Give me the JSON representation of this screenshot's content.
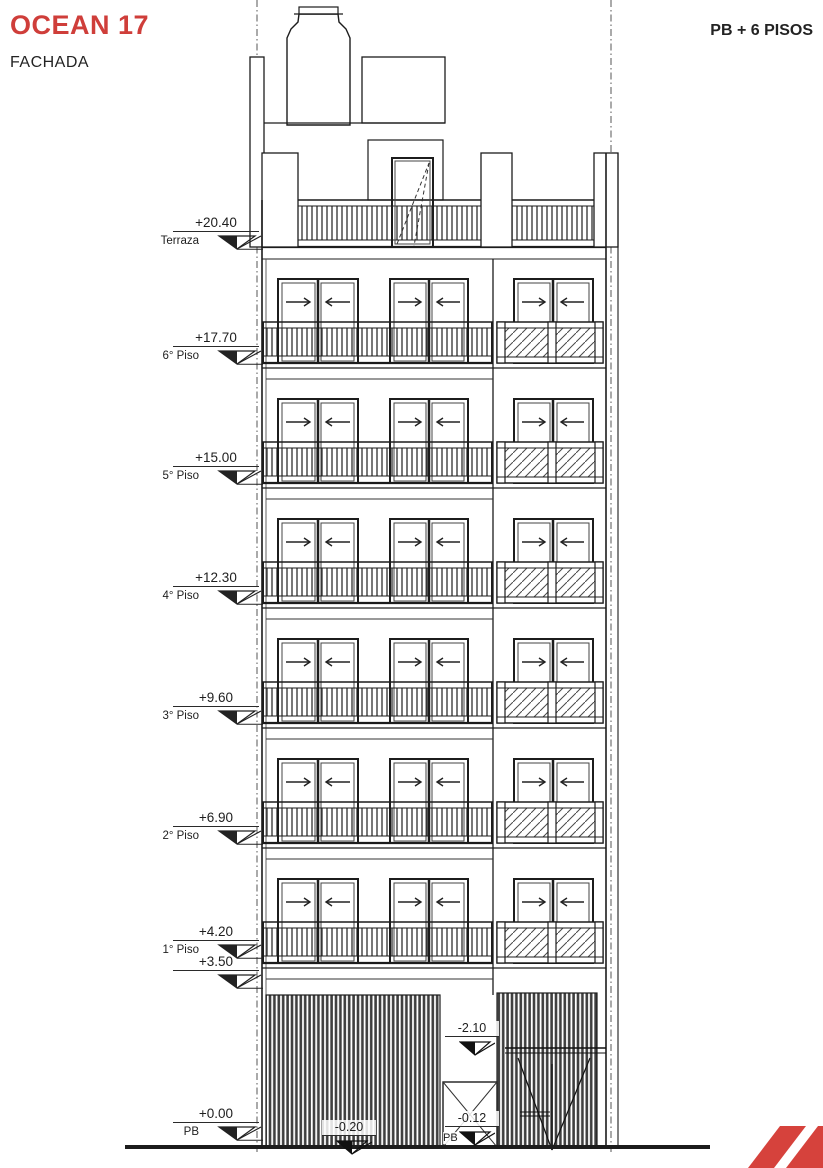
{
  "header": {
    "title": "OCEAN 17",
    "subtitle": "FACHADA",
    "floors_label": "PB + 6 PISOS"
  },
  "levels": [
    {
      "value": "+20.40",
      "label": "Terraza"
    },
    {
      "value": "+17.70",
      "label": "6° Piso"
    },
    {
      "value": "+15.00",
      "label": "5° Piso"
    },
    {
      "value": "+12.30",
      "label": "4° Piso"
    },
    {
      "value": "+9.60",
      "label": "3° Piso"
    },
    {
      "value": "+6.90",
      "label": "2° Piso"
    },
    {
      "value": "+4.20",
      "label": "1° Piso"
    },
    {
      "value": "+3.50",
      "label": ""
    },
    {
      "value": "+0.00",
      "label": "PB"
    }
  ],
  "interior_levels": [
    {
      "value": "-2.10",
      "label": ""
    },
    {
      "value": "-0.12",
      "label": "PB"
    },
    {
      "value": "-0.20",
      "label": ""
    }
  ],
  "icons": {
    "window_slide_right": "arrow-right",
    "window_slide_left": "arrow-left",
    "level_datum": "half-filled-triangle"
  },
  "colors": {
    "accent_red": "#cf3e3a",
    "line": "#2a2a2a",
    "background": "#ffffff"
  },
  "drawing_type": "building facade elevation"
}
